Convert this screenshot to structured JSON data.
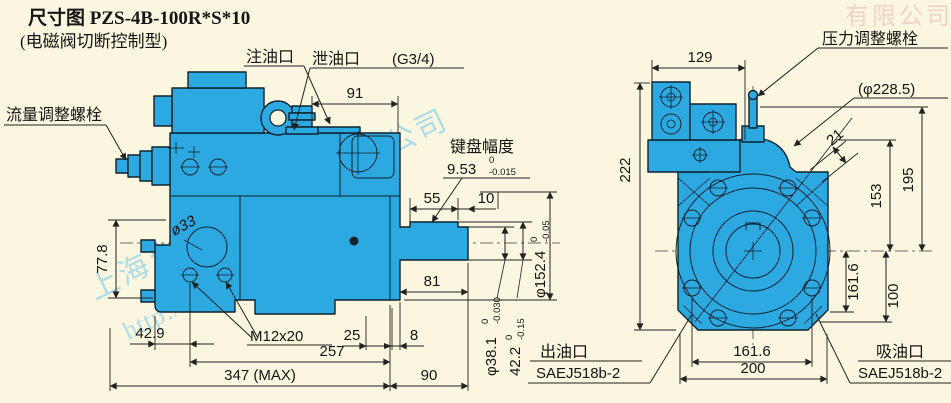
{
  "colors": {
    "background": "#fbf6df",
    "body_fill": "#2da9e2",
    "line": "#10222e",
    "watermark_blue": "#6ec7ef",
    "watermark_red": "#dd8f8f"
  },
  "title": {
    "line1": "尺寸图 PZS-4B-100R*S*10",
    "line2": "(电磁阀切断控制型)"
  },
  "watermark": {
    "company": "上海台拓液压机械有限公司",
    "url": "http://www.ttyytw.com",
    "corner": "有限公司"
  },
  "left_view": {
    "callouts": {
      "flow_bolt": "流量调整螺栓",
      "fill_port": "注油口",
      "drain_port": "泄油口",
      "drain_thread": "(G3/4)",
      "key_label": "键盘幅度",
      "key_value": "9.53",
      "key_tol_upper": "0",
      "key_tol_lower": "-0.015",
      "thread_spec": "M12x20",
      "hole_dia": "ø33"
    },
    "dims": {
      "top_width": "91",
      "key_length": "55",
      "key_offset": "10",
      "pilot_dia": "φ152.4",
      "pilot_tol_upper": "0",
      "pilot_tol_lower": "-0.05",
      "shaft_len": "81",
      "foot_height": "77.8",
      "foot_offset": "42.9",
      "mount_25": "25",
      "mount_8": "8",
      "body_len": "257",
      "max_len": "347 (MAX)",
      "shaft_ext": "90",
      "shaft_dia": "φ38.1",
      "shaft_dia_tol_upper": "0",
      "shaft_dia_tol_lower": "-0.030",
      "key_height": "42.2",
      "key_height_tol_upper": "0",
      "key_height_tol_lower": "-0.15"
    }
  },
  "right_view": {
    "callouts": {
      "pressure_bolt": "压力调整螺栓",
      "pilot_circle": "(φ228.5)",
      "outlet_label": "出油口",
      "outlet_std": "SAEJ518b-2",
      "suction_label": "吸油口",
      "suction_std": "SAEJ518b-2"
    },
    "dims": {
      "valve_width": "129",
      "height": "222",
      "notch": "21",
      "d153": "153",
      "d195": "195",
      "bolt_v": "161.6",
      "d100": "100",
      "bolt_h": "161.6",
      "width": "200"
    }
  }
}
